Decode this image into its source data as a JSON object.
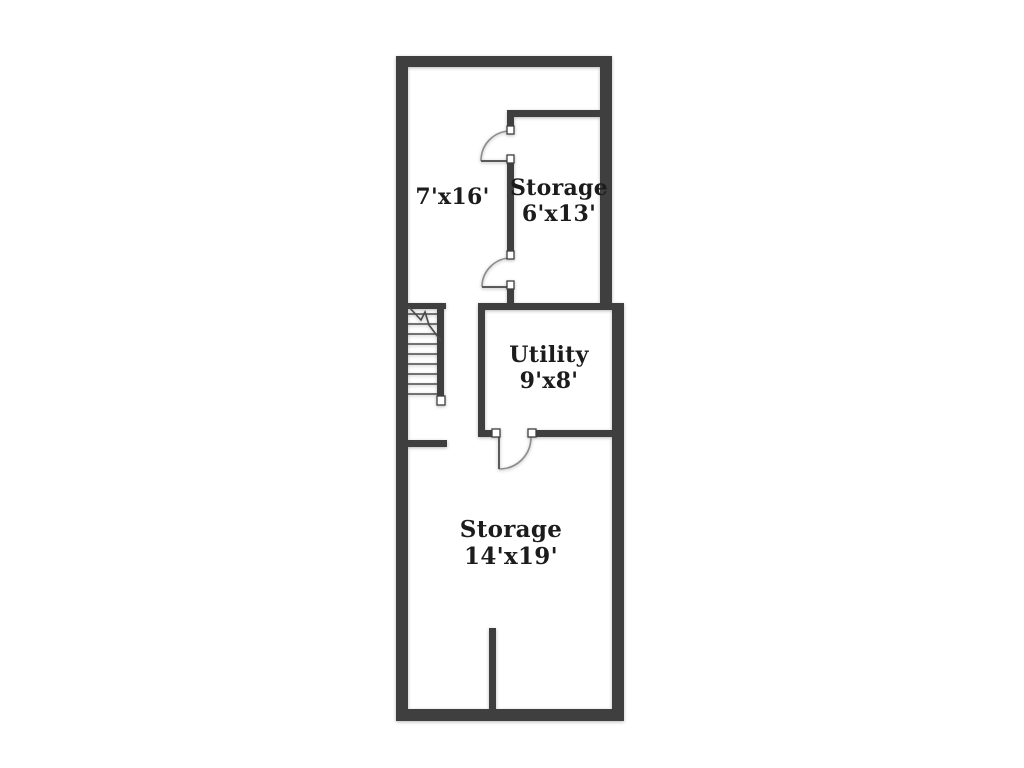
{
  "colors": {
    "wall": "#3f3f3f",
    "bg": "#ffffff",
    "text": "#1c1c1c",
    "line": "#4a4a4a",
    "arc": "#8c8c8c"
  },
  "rooms": [
    {
      "name": "",
      "dims": "7'x16'"
    },
    {
      "name": "Storage",
      "dims": "6'x13'"
    },
    {
      "name": "Utility",
      "dims": "9'x8'"
    },
    {
      "name": "Storage",
      "dims": "14'x19'"
    }
  ]
}
